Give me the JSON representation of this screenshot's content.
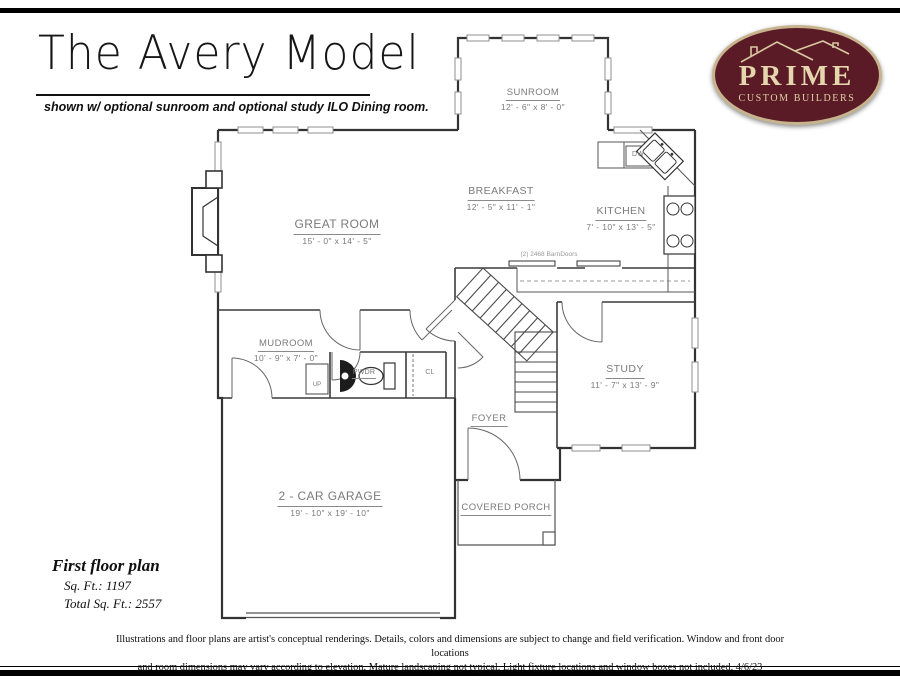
{
  "header": {
    "title": "The Avery Model",
    "subtitle": "shown w/ optional sunroom and optional study ILO Dining room."
  },
  "logo": {
    "name": "PRIME",
    "tagline": "CUSTOM BUILDERS",
    "colors": {
      "background": "#5a1b26",
      "border": "#c7b38d",
      "text": "#e6d6ae"
    }
  },
  "rooms": {
    "sunroom": {
      "name": "SUNROOM",
      "dims": "12' - 6\" x 8' - 0\""
    },
    "great_room": {
      "name": "GREAT ROOM",
      "dims": "15' - 0\" x 14' - 5\""
    },
    "breakfast": {
      "name": "BREAKFAST",
      "dims": "12' - 5\" x 11' - 1\""
    },
    "kitchen": {
      "name": "KITCHEN",
      "dims": "7' - 10\" x 13' - 5\""
    },
    "mudroom": {
      "name": "MUDROOM",
      "dims": "10' - 9\" x 7' - 0\""
    },
    "study": {
      "name": "STUDY",
      "dims": "11' - 7\" x 13' - 9\""
    },
    "garage": {
      "name": "2 - CAR GARAGE",
      "dims": "19' - 10\" x 19' - 10\""
    },
    "foyer": {
      "name": "FOYER"
    },
    "covered_porch": {
      "name": "COVERED PORCH"
    },
    "powder": {
      "name": "PWDR"
    },
    "closet": {
      "name": "CL"
    }
  },
  "annotations": {
    "dishwasher": "DW",
    "up": "UP",
    "barn_doors": "(2) 2468 BarnDoors"
  },
  "footer": {
    "plan_label": "First floor plan",
    "sqft": "Sq. Ft.: 1197",
    "total_sqft": "Total Sq. Ft.: 2557",
    "disclaimer_line1": "Illustrations and floor plans are artist's conceptual renderings. Details, colors and dimensions are subject to change and field verification. Window and front door locations",
    "disclaimer_line2": "and room dimensions may vary according to elevation.  Mature landscaping not typical.  Light fixture locations and window boxes not included. 4/6/23"
  }
}
